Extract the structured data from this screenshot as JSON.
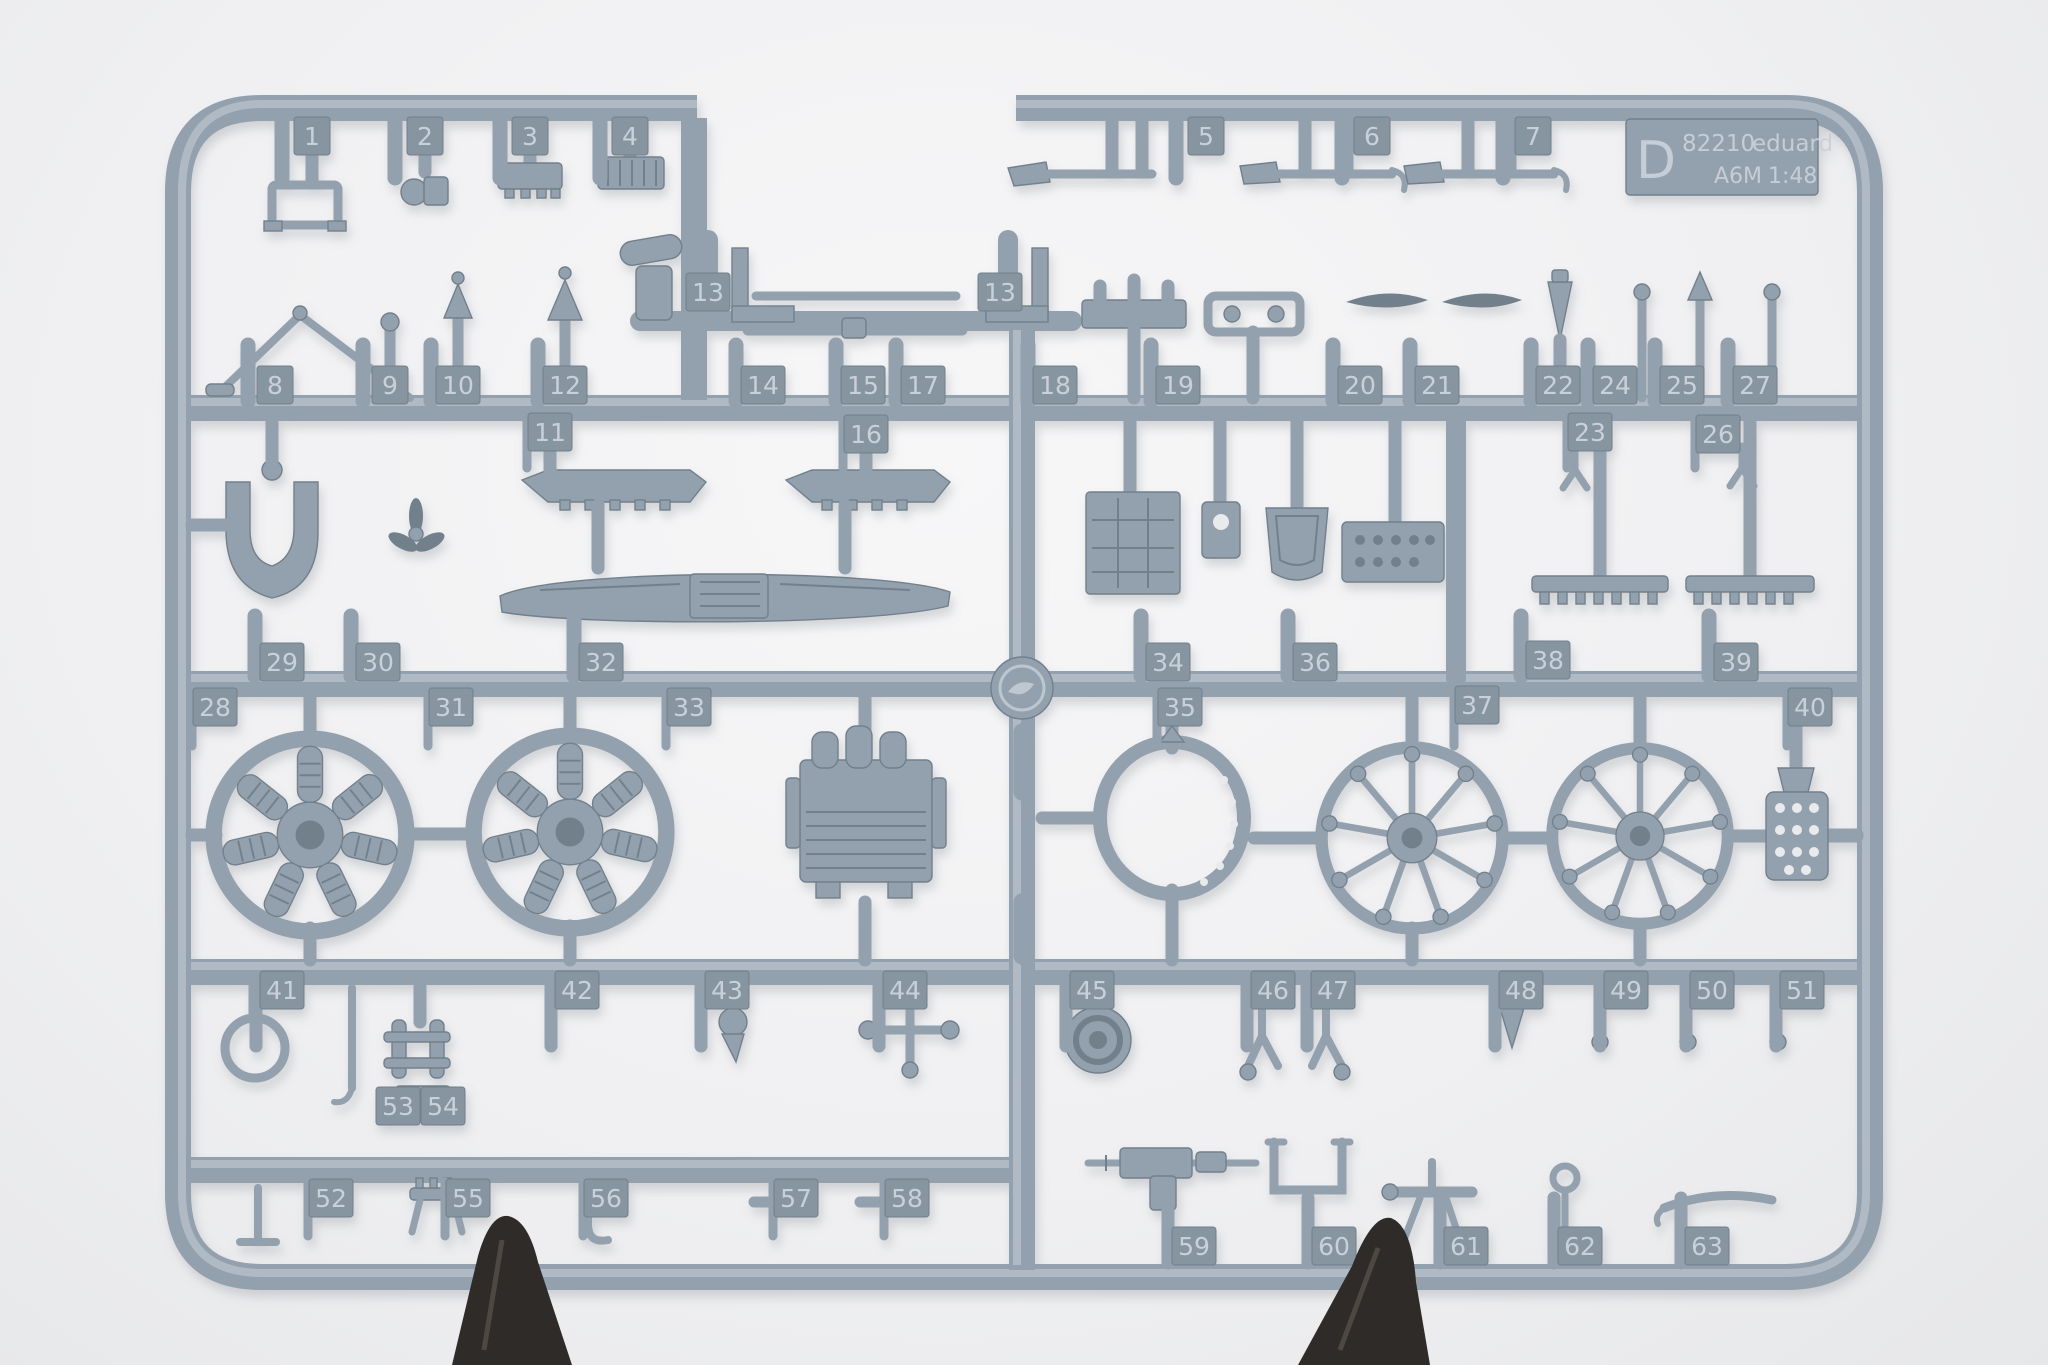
{
  "scene": {
    "description": "photo of a gray injection-molded plastic model kit sprue (frame D) on a white background, held by two dark clamp tips at the bottom"
  },
  "label": {
    "letter": "D",
    "code": "82210",
    "brand": "eduard",
    "model": "A6M",
    "scale": "1:48"
  },
  "colors": {
    "background": "#f1f1f3",
    "plastic": "#93a0ad",
    "plastic-dark": "#72808c",
    "plastic-deep": "#5d6a76",
    "plastic-light": "#c7cfd7",
    "tag-fill": "#8795a1",
    "tag-text": "#ccd5de",
    "emboss-text": "#c8d1da",
    "clamp": "#2e2b28",
    "shadow": "#8b9095"
  },
  "part_tags": [
    {
      "n": "1",
      "x": 312,
      "y": 136
    },
    {
      "n": "2",
      "x": 425,
      "y": 136
    },
    {
      "n": "3",
      "x": 530,
      "y": 136
    },
    {
      "n": "4",
      "x": 630,
      "y": 136
    },
    {
      "n": "5",
      "x": 1206,
      "y": 136
    },
    {
      "n": "6",
      "x": 1372,
      "y": 136
    },
    {
      "n": "7",
      "x": 1533,
      "y": 136
    },
    {
      "n": "13",
      "x": 708,
      "y": 292
    },
    {
      "n": "13",
      "x": 1000,
      "y": 292
    },
    {
      "n": "8",
      "x": 275,
      "y": 385
    },
    {
      "n": "9",
      "x": 390,
      "y": 385
    },
    {
      "n": "10",
      "x": 458,
      "y": 385
    },
    {
      "n": "12",
      "x": 565,
      "y": 385
    },
    {
      "n": "14",
      "x": 763,
      "y": 385
    },
    {
      "n": "15",
      "x": 863,
      "y": 385
    },
    {
      "n": "17",
      "x": 923,
      "y": 385
    },
    {
      "n": "18",
      "x": 1055,
      "y": 385
    },
    {
      "n": "19",
      "x": 1178,
      "y": 385
    },
    {
      "n": "20",
      "x": 1360,
      "y": 385
    },
    {
      "n": "21",
      "x": 1437,
      "y": 385
    },
    {
      "n": "22",
      "x": 1558,
      "y": 385
    },
    {
      "n": "24",
      "x": 1615,
      "y": 385
    },
    {
      "n": "25",
      "x": 1682,
      "y": 385
    },
    {
      "n": "27",
      "x": 1755,
      "y": 385
    },
    {
      "n": "11",
      "x": 550,
      "y": 432
    },
    {
      "n": "16",
      "x": 866,
      "y": 434
    },
    {
      "n": "23",
      "x": 1590,
      "y": 432
    },
    {
      "n": "26",
      "x": 1718,
      "y": 434
    },
    {
      "n": "29",
      "x": 282,
      "y": 662
    },
    {
      "n": "30",
      "x": 378,
      "y": 662
    },
    {
      "n": "32",
      "x": 601,
      "y": 662
    },
    {
      "n": "34",
      "x": 1168,
      "y": 662
    },
    {
      "n": "36",
      "x": 1315,
      "y": 662
    },
    {
      "n": "38",
      "x": 1548,
      "y": 660
    },
    {
      "n": "39",
      "x": 1736,
      "y": 662
    },
    {
      "n": "28",
      "x": 215,
      "y": 707
    },
    {
      "n": "31",
      "x": 451,
      "y": 707
    },
    {
      "n": "33",
      "x": 689,
      "y": 707
    },
    {
      "n": "35",
      "x": 1180,
      "y": 707
    },
    {
      "n": "37",
      "x": 1477,
      "y": 705
    },
    {
      "n": "40",
      "x": 1810,
      "y": 707
    },
    {
      "n": "41",
      "x": 282,
      "y": 990
    },
    {
      "n": "42",
      "x": 577,
      "y": 990
    },
    {
      "n": "43",
      "x": 727,
      "y": 990
    },
    {
      "n": "44",
      "x": 905,
      "y": 990
    },
    {
      "n": "45",
      "x": 1092,
      "y": 990
    },
    {
      "n": "46",
      "x": 1273,
      "y": 990
    },
    {
      "n": "47",
      "x": 1333,
      "y": 990
    },
    {
      "n": "48",
      "x": 1521,
      "y": 990
    },
    {
      "n": "49",
      "x": 1626,
      "y": 990
    },
    {
      "n": "50",
      "x": 1712,
      "y": 990
    },
    {
      "n": "51",
      "x": 1802,
      "y": 990
    },
    {
      "n": "53",
      "x": 398,
      "y": 1106
    },
    {
      "n": "54",
      "x": 443,
      "y": 1106
    },
    {
      "n": "52",
      "x": 331,
      "y": 1198
    },
    {
      "n": "55",
      "x": 468,
      "y": 1198
    },
    {
      "n": "56",
      "x": 606,
      "y": 1198
    },
    {
      "n": "57",
      "x": 796,
      "y": 1198
    },
    {
      "n": "58",
      "x": 907,
      "y": 1198
    },
    {
      "n": "59",
      "x": 1194,
      "y": 1246
    },
    {
      "n": "60",
      "x": 1334,
      "y": 1246
    },
    {
      "n": "61",
      "x": 1466,
      "y": 1246
    },
    {
      "n": "62",
      "x": 1580,
      "y": 1246
    },
    {
      "n": "63",
      "x": 1707,
      "y": 1246
    }
  ]
}
